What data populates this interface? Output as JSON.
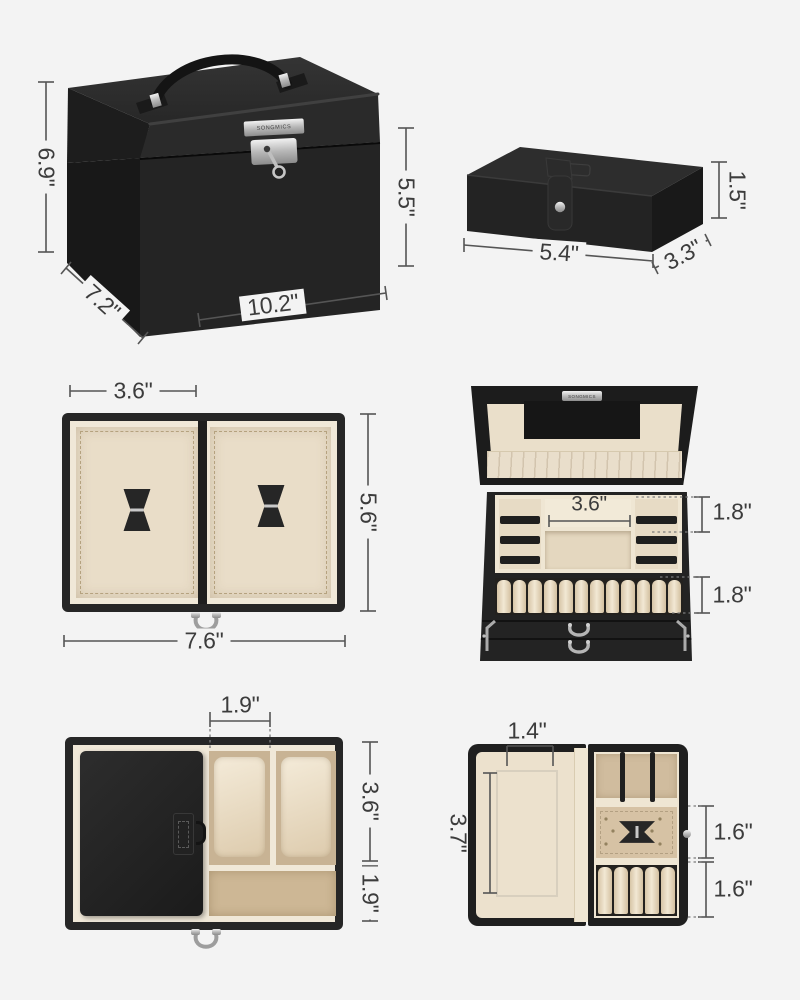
{
  "brand": "SONGMICS",
  "background": "#f3f3f3",
  "palette": {
    "box_black": "#232323",
    "lining_cream": "#f0e8d8",
    "velvet_beige": "#e9ddc8",
    "suede_tan": "#cdb795",
    "metal_silver": "#c9c9c9",
    "dimension_text": "#3c3c3c",
    "dimension_line": "#555555"
  },
  "views": {
    "closed_box": {
      "dims": {
        "left_height": "6.9\"",
        "front_height": "5.5\"",
        "width": "10.2\"",
        "depth": "7.2\""
      }
    },
    "small_case_closed": {
      "dims": {
        "width": "5.4\"",
        "depth": "3.3\"",
        "height": "1.5\""
      }
    },
    "drawer_two_sections": {
      "dims": {
        "section_width": "3.6\"",
        "depth": "5.6\"",
        "width": "7.6\""
      }
    },
    "open_box": {
      "dims": {
        "compartment_width": "3.6\"",
        "tray_depth": "1.8\"",
        "ring_row_depth": "1.8\""
      }
    },
    "drawer_watch": {
      "dims": {
        "slot_width": "1.9\"",
        "upper_depth": "3.6\"",
        "lower_depth": "1.9\""
      }
    },
    "small_case_open": {
      "dims": {
        "mirror_width": "1.4\"",
        "mirror_height": "3.7\"",
        "middle_depth": "1.6\"",
        "lower_depth": "1.6\""
      }
    }
  }
}
